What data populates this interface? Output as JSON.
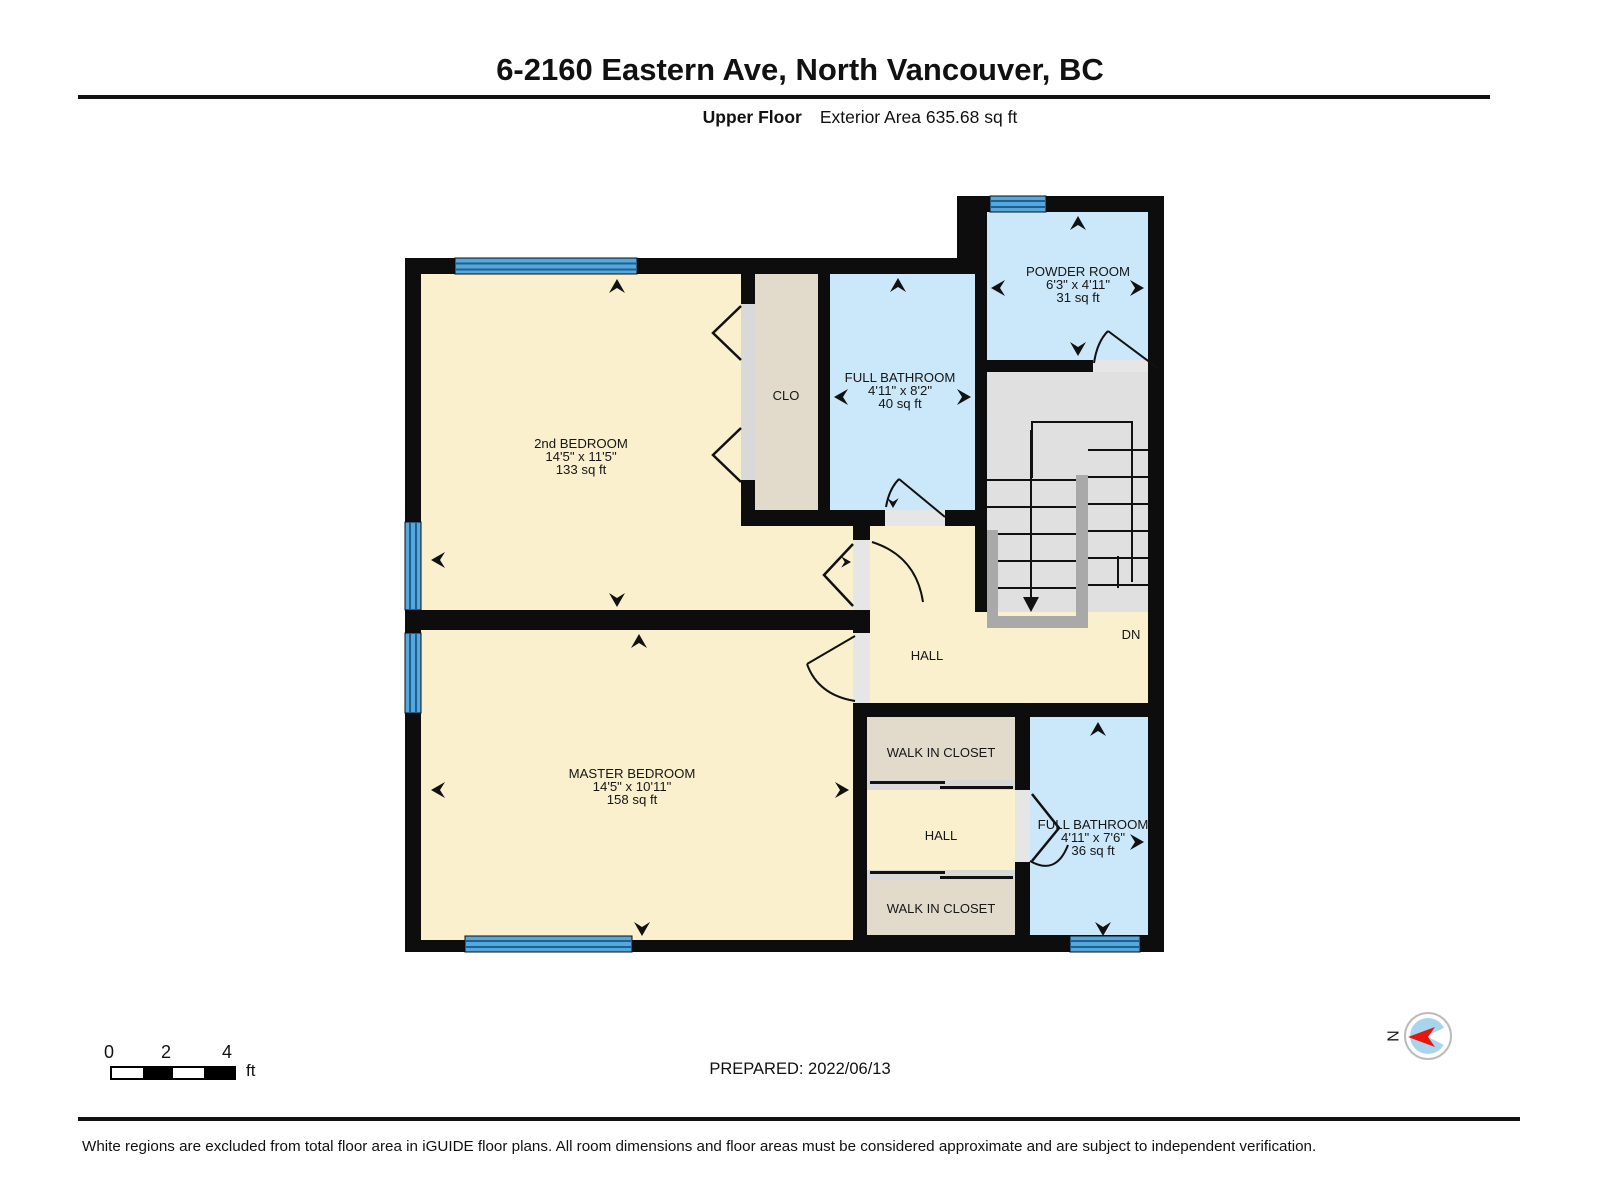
{
  "header": {
    "title": "6-2160 Eastern Ave, North Vancouver, BC",
    "floor_label": "Upper Floor",
    "area_label": "Exterior Area 635.68 sq ft"
  },
  "rooms": {
    "bedroom2": {
      "name": "2nd BEDROOM",
      "dims": "14'5\" x 11'5\"",
      "area": "133 sq ft"
    },
    "master_bedroom": {
      "name": "MASTER BEDROOM",
      "dims": "14'5\" x 10'11\"",
      "area": "158 sq ft"
    },
    "full_bathroom_top": {
      "name": "FULL BATHROOM",
      "dims": "4'11\" x 8'2\"",
      "area": "40 sq ft"
    },
    "powder_room": {
      "name": "POWDER ROOM",
      "dims": "6'3\" x 4'11\"",
      "area": "31 sq ft"
    },
    "full_bathroom_bottom": {
      "name": "FULL BATHROOM",
      "dims": "4'11\" x 7'6\"",
      "area": "36 sq ft"
    },
    "closet": {
      "name": "CLO"
    },
    "hall_upper": {
      "name": "HALL"
    },
    "hall_lower": {
      "name": "HALL"
    },
    "walk_in_closet_top": {
      "name": "WALK IN CLOSET"
    },
    "walk_in_closet_bottom": {
      "name": "WALK IN CLOSET"
    },
    "stairs": {
      "down_label": "DN"
    }
  },
  "scale_bar": {
    "tick0": "0",
    "tick2": "2",
    "tick4": "4",
    "unit": "ft"
  },
  "footer": {
    "prepared": "PREPARED: 2022/06/13",
    "disclaimer": "White regions are excluded from total floor area in iGUIDE floor plans. All room dimensions and floor areas must be considered approximate and are subject to independent verification."
  },
  "compass": {
    "north_label": "N"
  },
  "colors": {
    "wall": "#0d0d0d",
    "room_cream": "#FAF0CD",
    "room_blue": "#CBE7FA",
    "room_beige": "#E2DBCC",
    "stair_gray": "#E0E0E0",
    "railing_gray": "#A9A9A9",
    "door_gray": "#E6E6E6",
    "window_blue": "#56A8DC",
    "window_line": "#1D6193",
    "compass_blue": "#A8D4EE",
    "compass_red": "#E8150D"
  }
}
